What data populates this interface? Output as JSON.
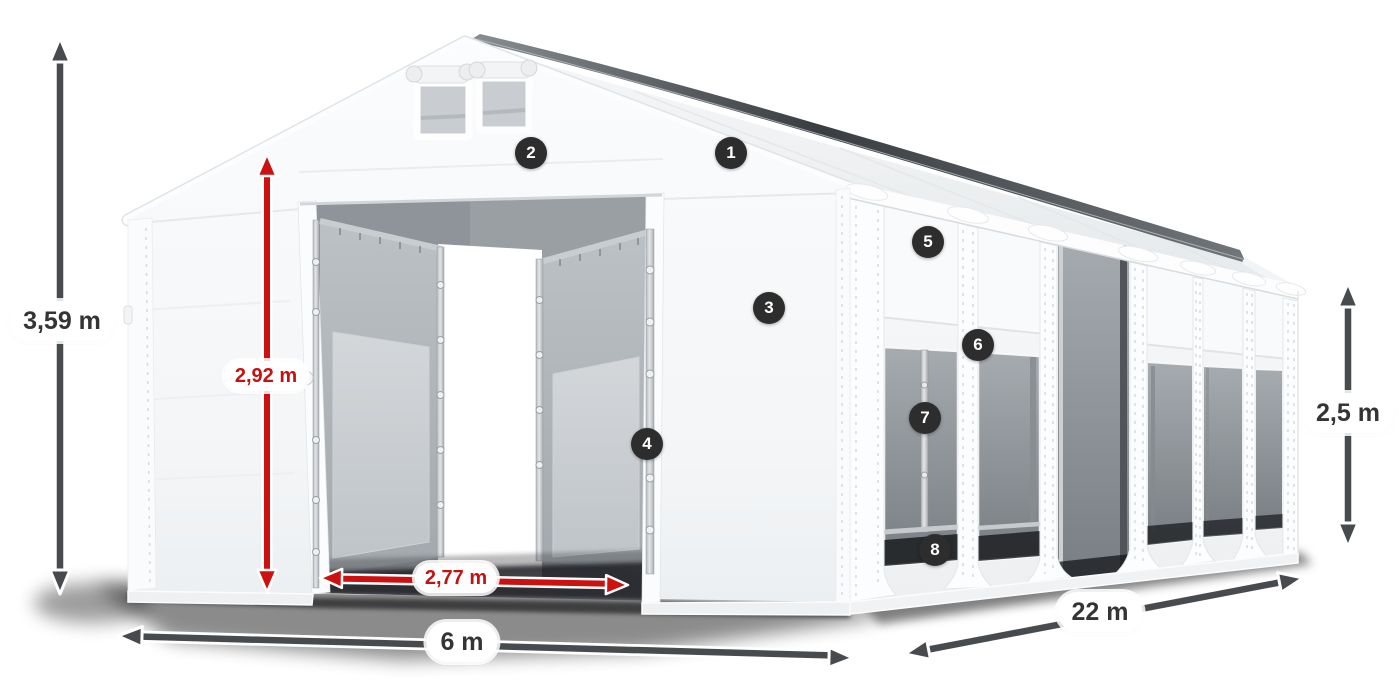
{
  "diagram": {
    "dimensions": {
      "total_height": "3,59 m",
      "entrance_height": "2,92 m",
      "entrance_width": "2,77 m",
      "width": "6 m",
      "length": "22 m",
      "side_height": "2,5 m"
    },
    "callouts": [
      "1",
      "2",
      "3",
      "4",
      "5",
      "6",
      "7",
      "8"
    ],
    "colors": {
      "arrow_dark": "#474b4e",
      "arrow_red": "#cd1111",
      "label_background": "#ffffff",
      "label_text_dark": "#323435",
      "label_text_red": "#c51111",
      "badge_background": "#2d2d2d",
      "badge_text": "#ffffff",
      "tent_fabric": "#f7f8fa",
      "window_gray": "#aab0b5"
    }
  }
}
